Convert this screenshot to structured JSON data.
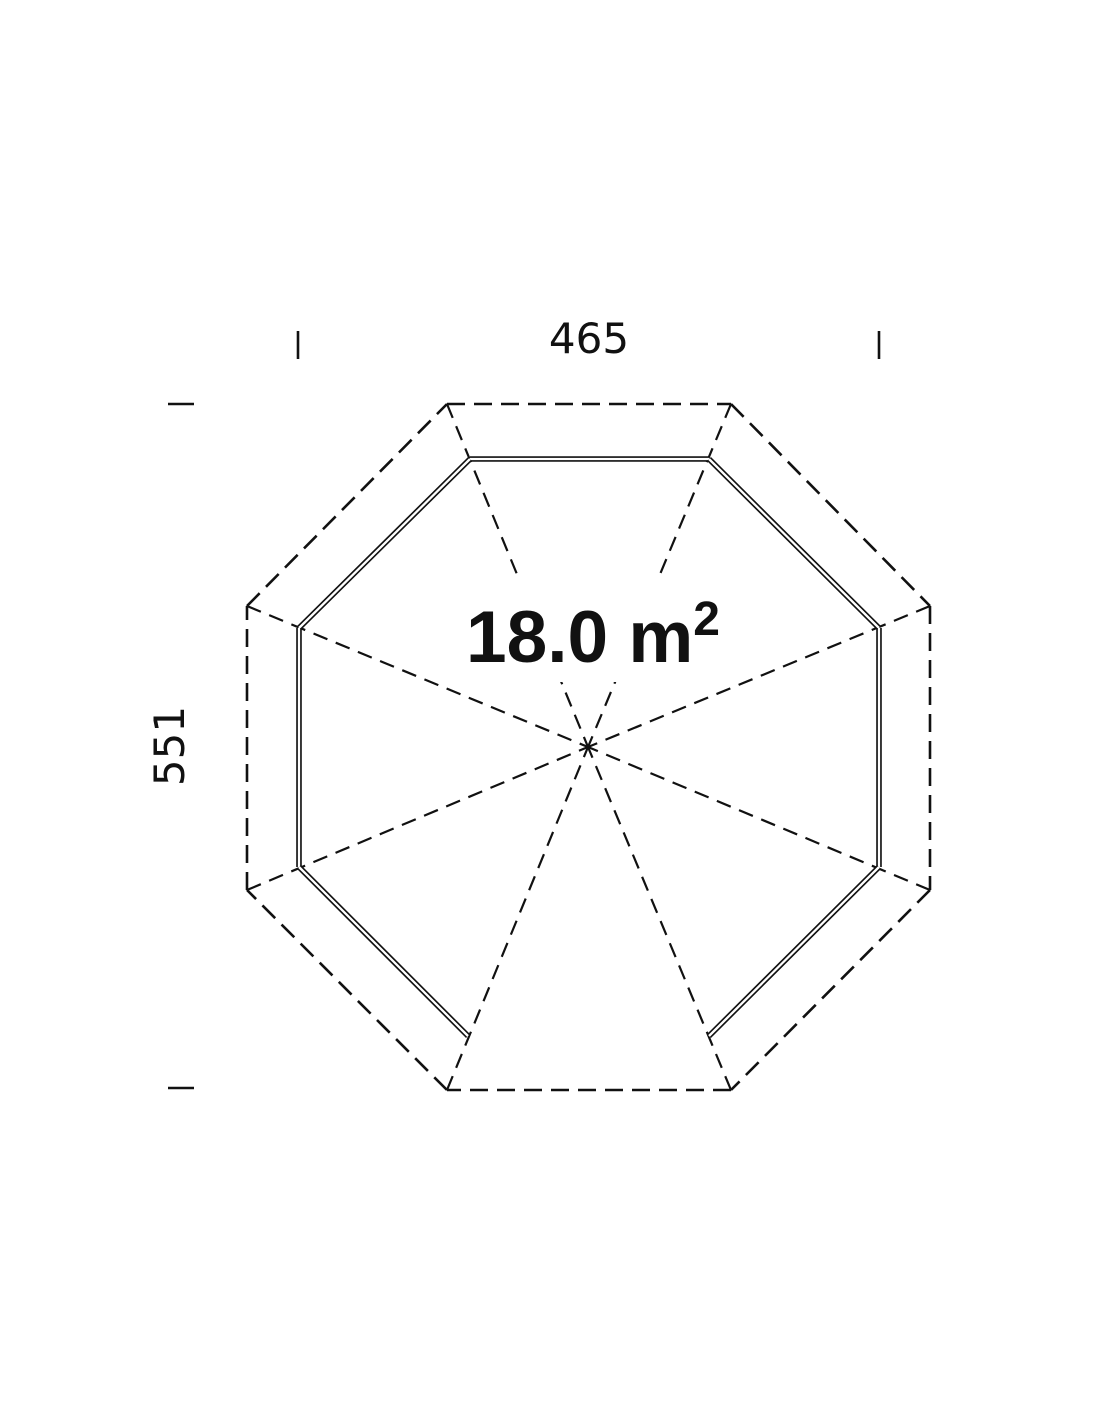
{
  "drawing": {
    "type": "floor-plan",
    "subject": "octagonal-gazebo-plan-view",
    "area_label": {
      "text": "18.0 m",
      "superscript": "2"
    },
    "dimensions": {
      "width_label": "465",
      "height_label": "551"
    },
    "colors": {
      "line": "#111111",
      "background": "#ffffff",
      "text": "#111111"
    }
  }
}
